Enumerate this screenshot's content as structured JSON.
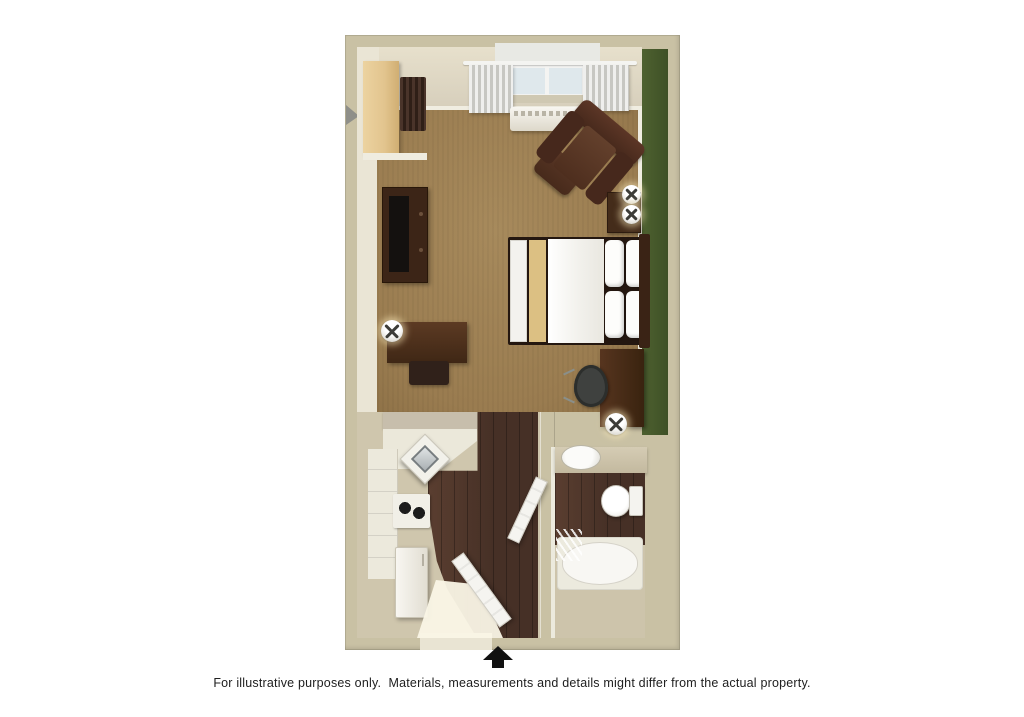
{
  "plan": {
    "rooms": [
      {
        "name": "living-sleeping-area",
        "floor": "carpet"
      },
      {
        "name": "kitchen",
        "floor": "hardwood"
      },
      {
        "name": "bathroom",
        "floor": "hardwood-with-tile-surround"
      },
      {
        "name": "closet",
        "floor": "none"
      },
      {
        "name": "entry",
        "floor": "tile"
      }
    ],
    "furniture": [
      "closet-shelves",
      "hanging-rod-with-hangers",
      "window",
      "curtains",
      "ptac-heat-ac-unit",
      "armchair",
      "ottoman",
      "nightstand",
      "table-lamp-1",
      "table-lamp-2",
      "bed-with-pillows",
      "tv-console",
      "television",
      "writing-desk",
      "desk-lamp",
      "desk-chair",
      "side-desk",
      "office-chair",
      "side-lamp",
      "kitchen-bar-counter",
      "corner-sink",
      "two-burner-cooktop",
      "cabinets",
      "refrigerator",
      "entry-door",
      "bathroom-door",
      "vanity-sink",
      "toilet",
      "bathtub",
      "shower-curtain"
    ],
    "colors": {
      "page_bg": "#ffffff",
      "wall_outer": "#c9c1a4",
      "wall_west_face": "#eae5d5",
      "trim_white": "#f0ede1",
      "accent_wall_green": "#4e6130",
      "accent_wall_green_dark": "#3e5026",
      "carpet": "#9a7c50",
      "carpet_light": "#a78a5c",
      "wood_floor": "#463026",
      "wood_floor_light": "#5a3e30",
      "tile_tan": "#cfc6ad",
      "window_glass": "#dfe8ec",
      "bed_runner": "#dcc083",
      "caption_text": "#202020",
      "arrow_black": "#111111"
    }
  },
  "annotations": {
    "entrance_arrow_icon": "up-arrow-icon",
    "caption": "For illustrative purposes only.  Materials, measurements and details might differ from the actual property."
  }
}
